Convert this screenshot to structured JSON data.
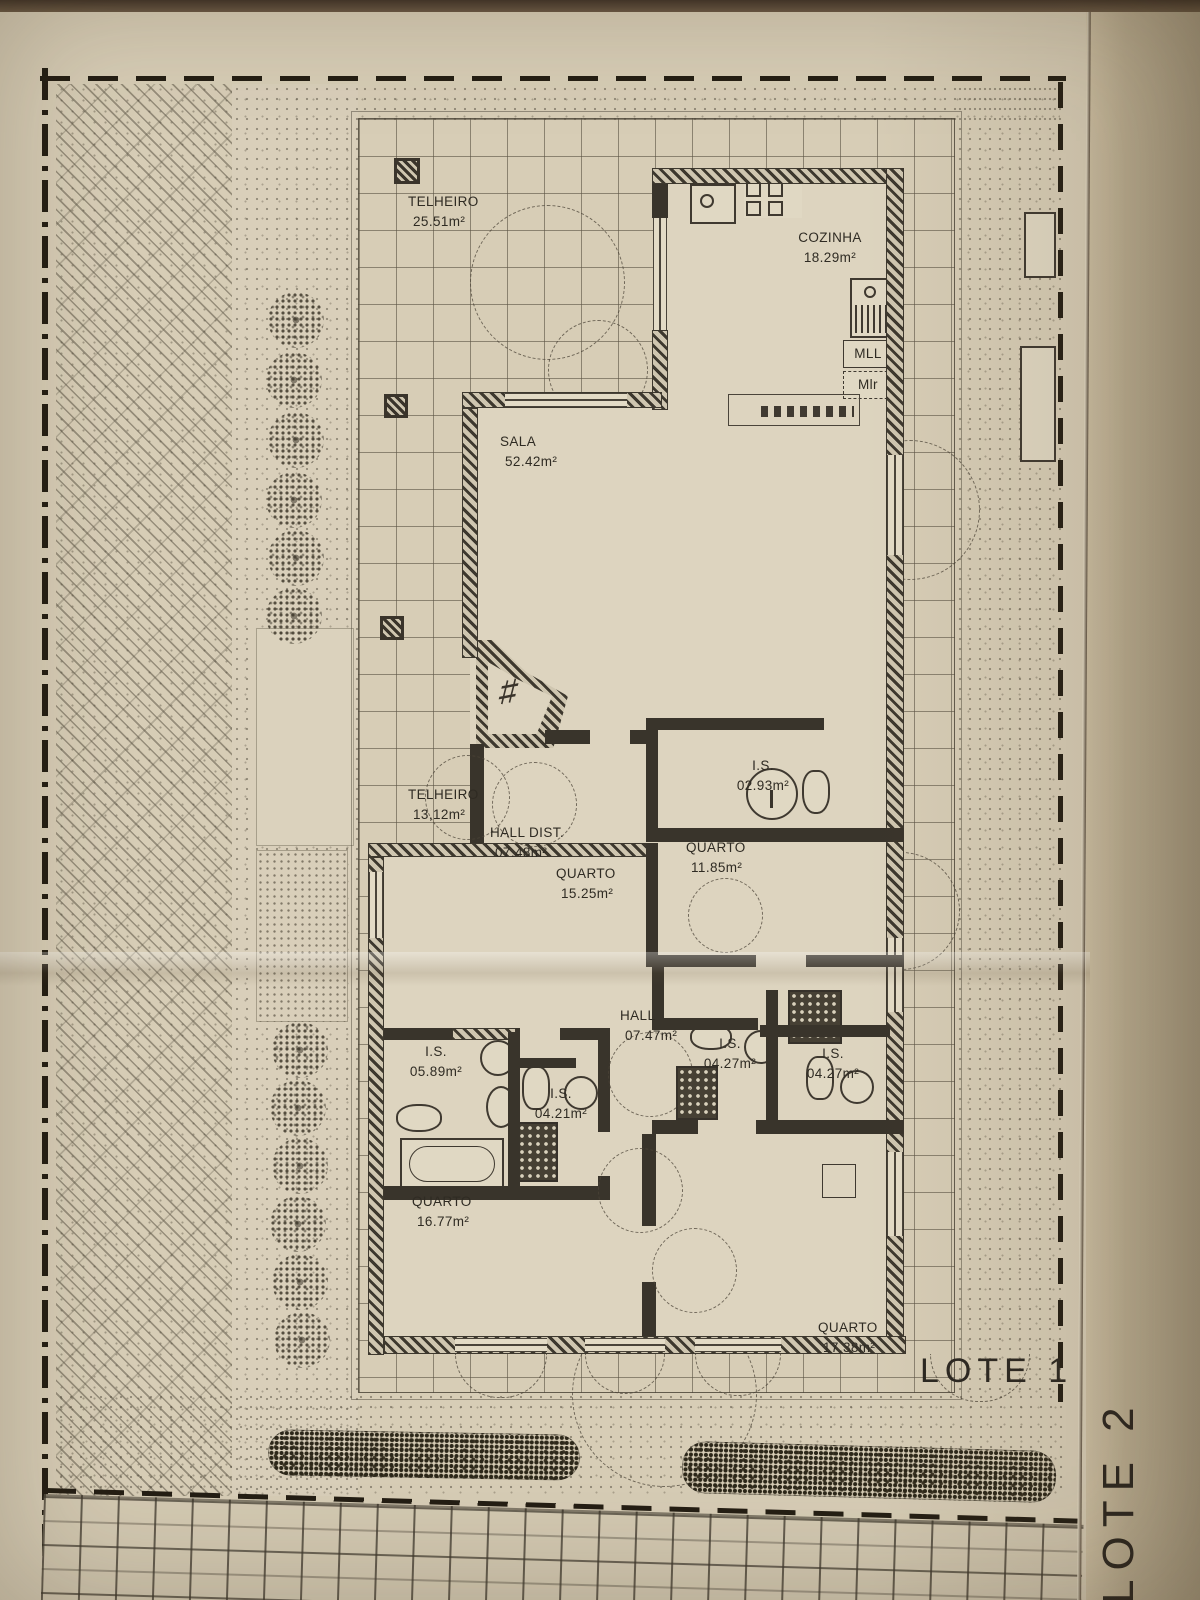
{
  "plan": {
    "rooms": [
      {
        "id": "telheiro-1",
        "name": "TELHEIRO",
        "area": "25.51m²"
      },
      {
        "id": "cozinha",
        "name": "COZINHA",
        "area": "18.29m²"
      },
      {
        "id": "sala",
        "name": "SALA",
        "area": "52.42m²"
      },
      {
        "id": "telheiro-2",
        "name": "TELHEIRO",
        "area": "13,12m²"
      },
      {
        "id": "hall-dist",
        "name": "HALL DIST.",
        "area": "07.48m²"
      },
      {
        "id": "quarto-1525",
        "name": "QUARTO",
        "area": "15.25m²"
      },
      {
        "id": "is-0293",
        "name": "I.S.",
        "area": "02.93m²"
      },
      {
        "id": "quarto-1185",
        "name": "QUARTO",
        "area": "11.85m²"
      },
      {
        "id": "hall",
        "name": "HALL",
        "area": "07.47m²"
      },
      {
        "id": "is-0589",
        "name": "I.S.",
        "area": "05.89m²"
      },
      {
        "id": "is-0421",
        "name": "I.S.",
        "area": "04.21m²"
      },
      {
        "id": "is-0427-left",
        "name": "I.S.",
        "area": "04.27m²"
      },
      {
        "id": "is-0427-right",
        "name": "I.S.",
        "area": "04.27m²"
      },
      {
        "id": "quarto-1677",
        "name": "QUARTO",
        "area": "16.77m²"
      },
      {
        "id": "quarto-1738",
        "name": "QUARTO",
        "area": "17.38m²"
      }
    ],
    "kitchen": {
      "mll": "MLL",
      "mlr": "Mlr"
    },
    "lots": {
      "lote1": "LOTE 1",
      "lote2": "LOTE 2"
    },
    "fireplace_mark": "♯"
  },
  "icons": [
    "stove-icon",
    "kitchen-sink-icon",
    "laundry-sink-icon",
    "counter-icon",
    "fireplace-icon",
    "washbasin-icon",
    "toilet-icon",
    "bidet-icon",
    "bathtub-icon",
    "shower-icon",
    "tree-icon",
    "hedge-icon",
    "planter-icon",
    "column-post-icon",
    "door-swing-arc"
  ],
  "colors": {
    "paper": "#d7cdb6",
    "fold_strip": "#bdb094",
    "ink": "#2f2b23",
    "wall": "#3a342b",
    "boundary": "#241e14"
  }
}
